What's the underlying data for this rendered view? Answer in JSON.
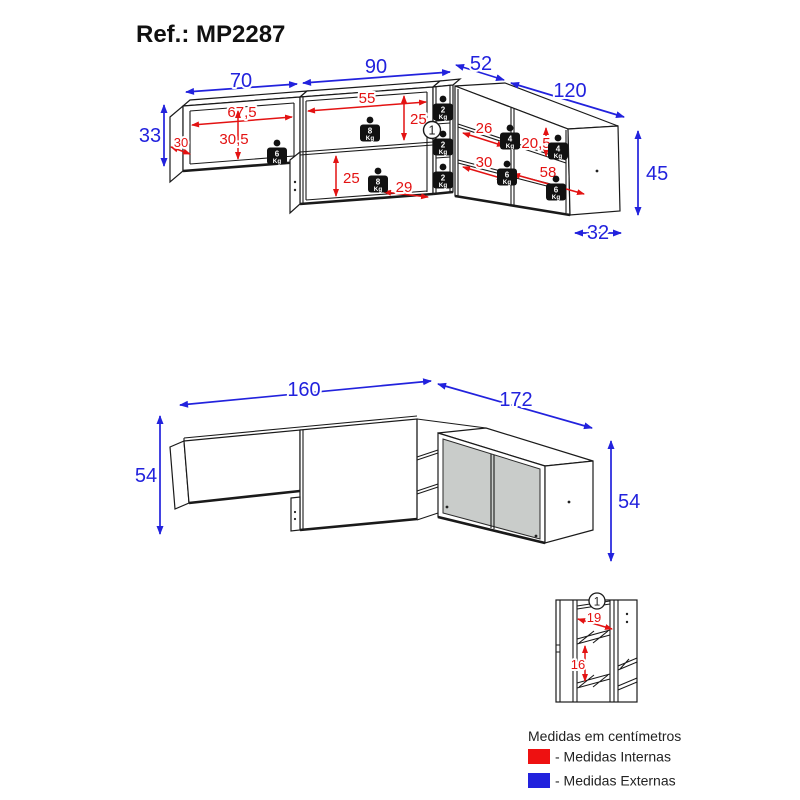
{
  "title": "Ref.: MP2287",
  "legend": {
    "heading": "Medidas em centímetros",
    "internal": {
      "label": "- Medidas Internas",
      "color": "#ee1111"
    },
    "external": {
      "label": "- Medidas Externas",
      "color": "#2222dd"
    }
  },
  "top_view": {
    "external": {
      "left_width": "70",
      "middle_width": "90",
      "corner_width": "52",
      "right_width": "120",
      "left_height": "33",
      "right_height": "45",
      "right_depth": "32"
    },
    "internal": {
      "left_width": "67,5",
      "left_height": "30,5",
      "left_depth": "30",
      "middle_width": "55",
      "middle_top_height": "25",
      "middle_bottom_height": "25",
      "middle_bottom_depth": "29",
      "right_top_width": "26",
      "right_top_height": "20,5",
      "right_middle_width": "30",
      "right_bottom_width": "58"
    },
    "detail_marker": "1",
    "weights": {
      "left": {
        "value": "6",
        "unit": "Kg"
      },
      "middle_top": {
        "value": "8",
        "unit": "Kg"
      },
      "middle_bottom": {
        "value": "8",
        "unit": "Kg"
      },
      "corner_top": {
        "value": "2",
        "unit": "Kg"
      },
      "corner_middle": {
        "value": "2",
        "unit": "Kg"
      },
      "corner_bottom": {
        "value": "2",
        "unit": "Kg"
      },
      "right_top_left": {
        "value": "4",
        "unit": "Kg"
      },
      "right_top_right": {
        "value": "4",
        "unit": "Kg"
      },
      "right_bottom_left": {
        "value": "6",
        "unit": "Kg"
      },
      "right_bottom_right": {
        "value": "6",
        "unit": "Kg"
      }
    }
  },
  "assembled_view": {
    "front_width": "160",
    "side_width": "172",
    "left_height": "54",
    "right_height": "54"
  },
  "detail_view": {
    "marker": "1",
    "inner_width": "19",
    "inner_height": "16"
  }
}
